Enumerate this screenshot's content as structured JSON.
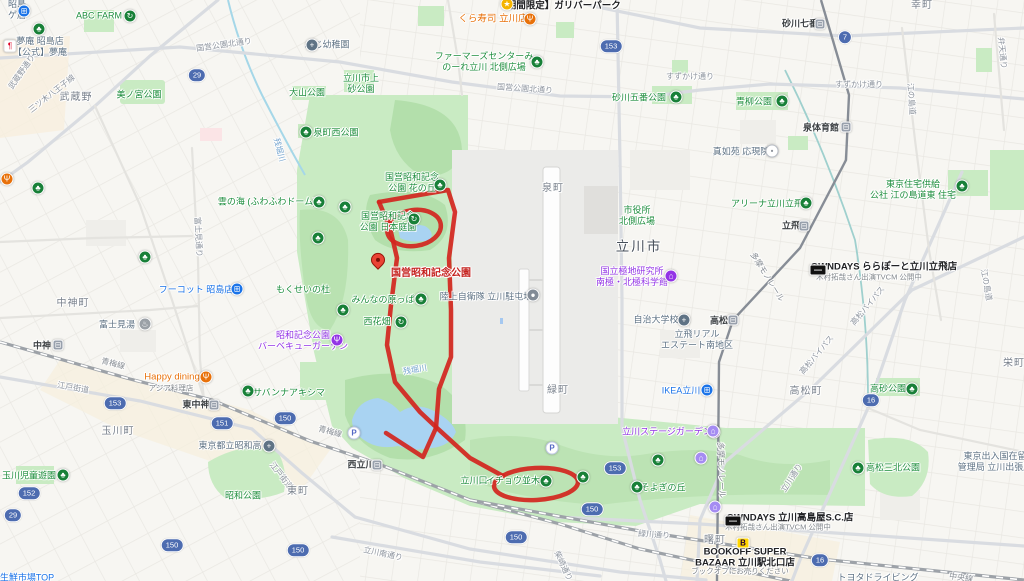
{
  "map": {
    "colors": {
      "park_green": "#c9ebc3",
      "forest_green": "#b3dfab",
      "water_blue": "#a9d3f2",
      "route_red": "#d2251e",
      "pin_red": "#ea4335",
      "badge_blue": "#4d6cb0"
    },
    "red_route": {
      "strokes": [
        [
          [
            379,
            202
          ],
          [
            448,
            190
          ],
          [
            455,
            212
          ],
          [
            449,
            258
          ],
          [
            451,
            310
          ],
          [
            451,
            357
          ],
          [
            439,
            389
          ],
          [
            436,
            428
          ],
          [
            423,
            457
          ],
          [
            386,
            433
          ]
        ],
        [
          [
            379,
            202
          ],
          [
            390,
            228
          ],
          [
            397,
            258
          ],
          [
            391,
            305
          ],
          [
            387,
            345
          ],
          [
            395,
            382
          ],
          [
            420,
            412
          ],
          [
            437,
            428
          ],
          [
            470,
            458
          ],
          [
            503,
            476
          ]
        ]
      ],
      "ellipses": [
        {
          "cx": 414,
          "cy": 228,
          "rx": 27,
          "ry": 18,
          "rot": -8
        },
        {
          "cx": 536,
          "cy": 484,
          "rx": 42,
          "ry": 16,
          "rot": -3
        }
      ],
      "pin": {
        "x": 378,
        "y": 273,
        "label": "国営昭和記念公園",
        "label_x": 391,
        "label_y": 274
      }
    },
    "labels": [
      {
        "x": 8,
        "y": 10,
        "k": "inst",
        "t": "昭島\nゲ店",
        "a": "l"
      },
      {
        "x": 99,
        "y": 16,
        "k": "park",
        "t": "ABC FARM"
      },
      {
        "x": 40,
        "y": 47,
        "k": "inst",
        "t": "夢庵 昭島店\n【公式】夢庵"
      },
      {
        "x": 559,
        "y": 6,
        "k": "black",
        "t": "【期間限定】ガリバーパーク"
      },
      {
        "x": 493,
        "y": 19,
        "k": "orange",
        "t": "くら寿司 立川店"
      },
      {
        "x": 484,
        "y": 62,
        "k": "park",
        "t": "ファーマーズセンターみ\nのーれ立川 北側広場"
      },
      {
        "x": 224,
        "y": 45,
        "k": "road",
        "t": "国営公園北通り",
        "r": -8
      },
      {
        "x": 525,
        "y": 89,
        "k": "road",
        "t": "国営公園北通り",
        "r": 4
      },
      {
        "x": 690,
        "y": 77,
        "k": "road",
        "t": "すずかけ通り"
      },
      {
        "x": 859,
        "y": 85,
        "k": "road",
        "t": "すずかけ通り"
      },
      {
        "x": 800,
        "y": 24,
        "k": "station",
        "t": "砂川七番"
      },
      {
        "x": 922,
        "y": 6,
        "k": "town",
        "t": "幸町"
      },
      {
        "x": 327,
        "y": 45,
        "k": "inst",
        "t": "ふじ幼稚園"
      },
      {
        "x": 139,
        "y": 95,
        "k": "park",
        "t": "美ノ宮公園"
      },
      {
        "x": 307,
        "y": 93,
        "k": "park",
        "t": "大山公園"
      },
      {
        "x": 361,
        "y": 84,
        "k": "park",
        "t": "立川市上\n砂公園"
      },
      {
        "x": 639,
        "y": 98,
        "k": "park",
        "t": "砂川五番公園"
      },
      {
        "x": 754,
        "y": 102,
        "k": "park",
        "t": "青柳公園"
      },
      {
        "x": 52,
        "y": 94,
        "k": "road",
        "t": "三ツ木八王子線",
        "r": -38
      },
      {
        "x": 22,
        "y": 72,
        "k": "road",
        "t": "武蔵野通り",
        "r": -55
      },
      {
        "x": 76,
        "y": 98,
        "k": "town",
        "t": "武蔵野"
      },
      {
        "x": 336,
        "y": 133,
        "k": "park",
        "t": "泉町西公園"
      },
      {
        "x": 279,
        "y": 150,
        "k": "water",
        "t": "残堀川",
        "r": 75
      },
      {
        "x": 821,
        "y": 128,
        "k": "station",
        "t": "泉体育館"
      },
      {
        "x": 741,
        "y": 152,
        "k": "inst",
        "t": "真如苑 応現院"
      },
      {
        "x": 911,
        "y": 99,
        "k": "road",
        "t": "江の島道",
        "r": 86
      },
      {
        "x": 1002,
        "y": 53,
        "k": "road",
        "t": "弁天通り",
        "r": 84
      },
      {
        "x": 412,
        "y": 183,
        "k": "park",
        "t": "国営昭和記念\n公園 花の丘"
      },
      {
        "x": 388,
        "y": 222,
        "k": "park",
        "t": "国営昭和記念\n公園 日本庭園"
      },
      {
        "x": 267,
        "y": 202,
        "k": "park",
        "t": "雲の海 (ふわふわドーム)"
      },
      {
        "x": 553,
        "y": 189,
        "k": "town",
        "t": "泉町"
      },
      {
        "x": 637,
        "y": 216,
        "k": "park",
        "t": "市役所\n北側広場"
      },
      {
        "x": 639,
        "y": 247,
        "k": "city",
        "t": "立川市"
      },
      {
        "x": 767,
        "y": 204,
        "k": "park",
        "t": "アリーナ立川立飛"
      },
      {
        "x": 913,
        "y": 190,
        "k": "park",
        "t": "東京住宅供給\n公社 江の島道東 住宅"
      },
      {
        "x": 791,
        "y": 226,
        "k": "station",
        "t": "立飛"
      },
      {
        "x": 884,
        "y": 267,
        "k": "black",
        "t": "OWNDAYS ららぽーと立川立飛店"
      },
      {
        "x": 869,
        "y": 277,
        "k": "sub",
        "t": "木村拓哉さん出演TVCM 公開中"
      },
      {
        "x": 632,
        "y": 277,
        "k": "purple",
        "t": "国立極地研究所\n南極・北極科学館"
      },
      {
        "x": 486,
        "y": 297,
        "k": "inst",
        "t": "陸上自衛隊 立川駐屯地"
      },
      {
        "x": 303,
        "y": 290,
        "k": "park",
        "t": "もくせいの杜"
      },
      {
        "x": 196,
        "y": 290,
        "k": "blue",
        "t": "フーコット 昭島店"
      },
      {
        "x": 73,
        "y": 304,
        "k": "town",
        "t": "中神町"
      },
      {
        "x": 383,
        "y": 300,
        "k": "park",
        "t": "みんなの原っぱ"
      },
      {
        "x": 377,
        "y": 322,
        "k": "park",
        "t": "西花畑"
      },
      {
        "x": 656,
        "y": 320,
        "k": "inst",
        "t": "自治大学校"
      },
      {
        "x": 719,
        "y": 321,
        "k": "station",
        "t": "高松"
      },
      {
        "x": 697,
        "y": 340,
        "k": "inst",
        "t": "立飛リアル\nエステート南地区"
      },
      {
        "x": 303,
        "y": 341,
        "k": "purple",
        "t": "昭和記念公園\nバーベキューガーデン"
      },
      {
        "x": 117,
        "y": 325,
        "k": "inst",
        "t": "富士見湯"
      },
      {
        "x": 198,
        "y": 237,
        "k": "road",
        "t": "富士見通り",
        "r": 87
      },
      {
        "x": 986,
        "y": 285,
        "k": "road",
        "t": "江の島道",
        "r": 80
      },
      {
        "x": 767,
        "y": 277,
        "k": "rail",
        "t": "多摩モノレール",
        "r": 58
      },
      {
        "x": 42,
        "y": 346,
        "k": "station",
        "t": "中神"
      },
      {
        "x": 172,
        "y": 377,
        "k": "orange",
        "t": "Happy dining"
      },
      {
        "x": 171,
        "y": 388,
        "k": "sub",
        "t": "アジア料理店"
      },
      {
        "x": 289,
        "y": 393,
        "k": "park",
        "t": "サバンナアキシマ"
      },
      {
        "x": 196,
        "y": 405,
        "k": "station",
        "t": "東中神"
      },
      {
        "x": 113,
        "y": 364,
        "k": "rail",
        "t": "青梅線",
        "r": 14
      },
      {
        "x": 330,
        "y": 432,
        "k": "rail",
        "t": "青梅線",
        "r": 15
      },
      {
        "x": 73,
        "y": 388,
        "k": "road",
        "t": "江戸街道",
        "r": 10
      },
      {
        "x": 281,
        "y": 476,
        "k": "road",
        "t": "江戸街道",
        "r": 52
      },
      {
        "x": 118,
        "y": 432,
        "k": "town",
        "t": "玉川町"
      },
      {
        "x": 29,
        "y": 476,
        "k": "park",
        "t": "玉川児童遊園"
      },
      {
        "x": 230,
        "y": 446,
        "k": "inst",
        "t": "東京都立昭和高"
      },
      {
        "x": 243,
        "y": 496,
        "k": "park",
        "t": "昭和公園"
      },
      {
        "x": 298,
        "y": 492,
        "k": "town",
        "t": "東町"
      },
      {
        "x": 415,
        "y": 370,
        "k": "water",
        "t": "残堀川",
        "r": -10
      },
      {
        "x": 558,
        "y": 391,
        "k": "town",
        "t": "緑町"
      },
      {
        "x": 681,
        "y": 391,
        "k": "blue",
        "t": "IKEA立川"
      },
      {
        "x": 806,
        "y": 392,
        "k": "town",
        "t": "高松町"
      },
      {
        "x": 868,
        "y": 306,
        "k": "road",
        "t": "高松バイパス",
        "r": -50
      },
      {
        "x": 817,
        "y": 355,
        "k": "road",
        "t": "高松バイパス",
        "r": -50
      },
      {
        "x": 888,
        "y": 389,
        "k": "park",
        "t": "高砂公園"
      },
      {
        "x": 667,
        "y": 432,
        "k": "purple",
        "t": "立川ステージガーデン"
      },
      {
        "x": 361,
        "y": 465,
        "k": "station",
        "t": "西立川"
      },
      {
        "x": 474,
        "y": 481,
        "k": "park",
        "t": "立川口"
      },
      {
        "x": 513,
        "y": 481,
        "k": "park",
        "t": "イチョウ並木"
      },
      {
        "x": 663,
        "y": 488,
        "k": "park",
        "t": "そよぎの丘"
      },
      {
        "x": 893,
        "y": 468,
        "k": "park",
        "t": "高松三北公園"
      },
      {
        "x": 995,
        "y": 462,
        "k": "inst",
        "t": "東京出入国在留\n管理局 立川出張所"
      },
      {
        "x": 792,
        "y": 478,
        "k": "road",
        "t": "立川通り",
        "r": -57
      },
      {
        "x": 721,
        "y": 470,
        "k": "rail",
        "t": "多摩モノレール",
        "r": 88
      },
      {
        "x": 654,
        "y": 535,
        "k": "road",
        "t": "緑川通り",
        "r": 4
      },
      {
        "x": 563,
        "y": 566,
        "k": "road",
        "t": "柴崎通り",
        "r": 65
      },
      {
        "x": 383,
        "y": 554,
        "k": "road",
        "t": "立川南通り",
        "r": 12
      },
      {
        "x": 790,
        "y": 518,
        "k": "black",
        "t": "OWNDAYS 立川高島屋S.C.店"
      },
      {
        "x": 778,
        "y": 527,
        "k": "sub",
        "t": "木村拓哉さん出演TVCM 公開中"
      },
      {
        "x": 745,
        "y": 558,
        "k": "black",
        "t": "BOOKOFF SUPER\nBAZAAR 立川駅北口店"
      },
      {
        "x": 740,
        "y": 571,
        "k": "sub",
        "t": "ブックオフにお売りください"
      },
      {
        "x": 715,
        "y": 541,
        "k": "town",
        "t": "曙町"
      },
      {
        "x": 1014,
        "y": 364,
        "k": "town",
        "t": "栄町"
      },
      {
        "x": 961,
        "y": 578,
        "k": "rail",
        "t": "中央線",
        "r": 8
      },
      {
        "x": 27,
        "y": 578,
        "k": "blue",
        "t": "生鮮市場TOP"
      },
      {
        "x": 878,
        "y": 578,
        "k": "inst",
        "t": "トヨタドライビング"
      }
    ],
    "badges": [
      {
        "n": "29",
        "x": 197,
        "y": 75
      },
      {
        "n": "153",
        "x": 611,
        "y": 46
      },
      {
        "n": "7",
        "x": 845,
        "y": 37
      },
      {
        "n": "153",
        "x": 115,
        "y": 403
      },
      {
        "n": "151",
        "x": 222,
        "y": 423
      },
      {
        "n": "150",
        "x": 285,
        "y": 418
      },
      {
        "n": "152",
        "x": 29,
        "y": 493
      },
      {
        "n": "29",
        "x": 13,
        "y": 515
      },
      {
        "n": "150",
        "x": 172,
        "y": 545
      },
      {
        "n": "150",
        "x": 298,
        "y": 550
      },
      {
        "n": "153",
        "x": 615,
        "y": 468
      },
      {
        "n": "150",
        "x": 592,
        "y": 509
      },
      {
        "n": "150",
        "x": 516,
        "y": 537
      },
      {
        "n": "16",
        "x": 871,
        "y": 400
      },
      {
        "n": "16",
        "x": 820,
        "y": 560
      }
    ],
    "icons": [
      {
        "x": 24,
        "y": 11,
        "k": "cart"
      },
      {
        "x": 10,
        "y": 46,
        "k": "box"
      },
      {
        "x": 130,
        "y": 16,
        "k": "rec"
      },
      {
        "x": 507,
        "y": 4,
        "k": "ylw"
      },
      {
        "x": 530,
        "y": 19,
        "k": "rest"
      },
      {
        "x": 537,
        "y": 62,
        "k": "tree"
      },
      {
        "x": 820,
        "y": 24,
        "k": "sta"
      },
      {
        "x": 312,
        "y": 45,
        "k": "sch"
      },
      {
        "x": 306,
        "y": 132,
        "k": "tree"
      },
      {
        "x": 676,
        "y": 97,
        "k": "tree"
      },
      {
        "x": 782,
        "y": 101,
        "k": "tree"
      },
      {
        "x": 846,
        "y": 127,
        "k": "sta"
      },
      {
        "x": 772,
        "y": 151,
        "k": "shr"
      },
      {
        "x": 440,
        "y": 185,
        "k": "tree"
      },
      {
        "x": 414,
        "y": 219,
        "k": "rec"
      },
      {
        "x": 319,
        "y": 202,
        "k": "tree"
      },
      {
        "x": 345,
        "y": 207,
        "k": "tree"
      },
      {
        "x": 962,
        "y": 186,
        "k": "tree"
      },
      {
        "x": 806,
        "y": 203,
        "k": "tree"
      },
      {
        "x": 804,
        "y": 226,
        "k": "sta"
      },
      {
        "x": 818,
        "y": 270,
        "k": "own"
      },
      {
        "x": 671,
        "y": 276,
        "k": "mus"
      },
      {
        "x": 533,
        "y": 295,
        "k": "base"
      },
      {
        "x": 237,
        "y": 289,
        "k": "cart"
      },
      {
        "x": 421,
        "y": 299,
        "k": "tree"
      },
      {
        "x": 401,
        "y": 322,
        "k": "rec"
      },
      {
        "x": 684,
        "y": 320,
        "k": "sch"
      },
      {
        "x": 733,
        "y": 320,
        "k": "sta"
      },
      {
        "x": 337,
        "y": 340,
        "k": "pfood"
      },
      {
        "x": 145,
        "y": 324,
        "k": "ons"
      },
      {
        "x": 58,
        "y": 345,
        "k": "sta"
      },
      {
        "x": 206,
        "y": 377,
        "k": "rest"
      },
      {
        "x": 248,
        "y": 391,
        "k": "tree"
      },
      {
        "x": 214,
        "y": 405,
        "k": "sta"
      },
      {
        "x": 63,
        "y": 475,
        "k": "tree"
      },
      {
        "x": 269,
        "y": 446,
        "k": "sch"
      },
      {
        "x": 707,
        "y": 390,
        "k": "bag"
      },
      {
        "x": 714,
        "y": 432,
        "k": "star"
      },
      {
        "x": 377,
        "y": 465,
        "k": "sta"
      },
      {
        "x": 354,
        "y": 433,
        "k": "prk"
      },
      {
        "x": 552,
        "y": 448,
        "k": "prk"
      },
      {
        "x": 546,
        "y": 481,
        "k": "tree"
      },
      {
        "x": 583,
        "y": 477,
        "k": "tree"
      },
      {
        "x": 637,
        "y": 487,
        "k": "tree"
      },
      {
        "x": 658,
        "y": 460,
        "k": "tree"
      },
      {
        "x": 912,
        "y": 389,
        "k": "tree"
      },
      {
        "x": 858,
        "y": 468,
        "k": "tree"
      },
      {
        "x": 733,
        "y": 521,
        "k": "own"
      },
      {
        "x": 743,
        "y": 543,
        "k": "bok"
      },
      {
        "x": 713,
        "y": 431,
        "k": "htl"
      },
      {
        "x": 701,
        "y": 458,
        "k": "htl"
      },
      {
        "x": 715,
        "y": 507,
        "k": "htl"
      },
      {
        "x": 38,
        "y": 188,
        "k": "tree"
      },
      {
        "x": 318,
        "y": 238,
        "k": "tree"
      },
      {
        "x": 145,
        "y": 257,
        "k": "tree"
      },
      {
        "x": 343,
        "y": 310,
        "k": "tree"
      },
      {
        "x": 7,
        "y": 179,
        "k": "rest"
      },
      {
        "x": 39,
        "y": 29,
        "k": "tree"
      }
    ]
  }
}
